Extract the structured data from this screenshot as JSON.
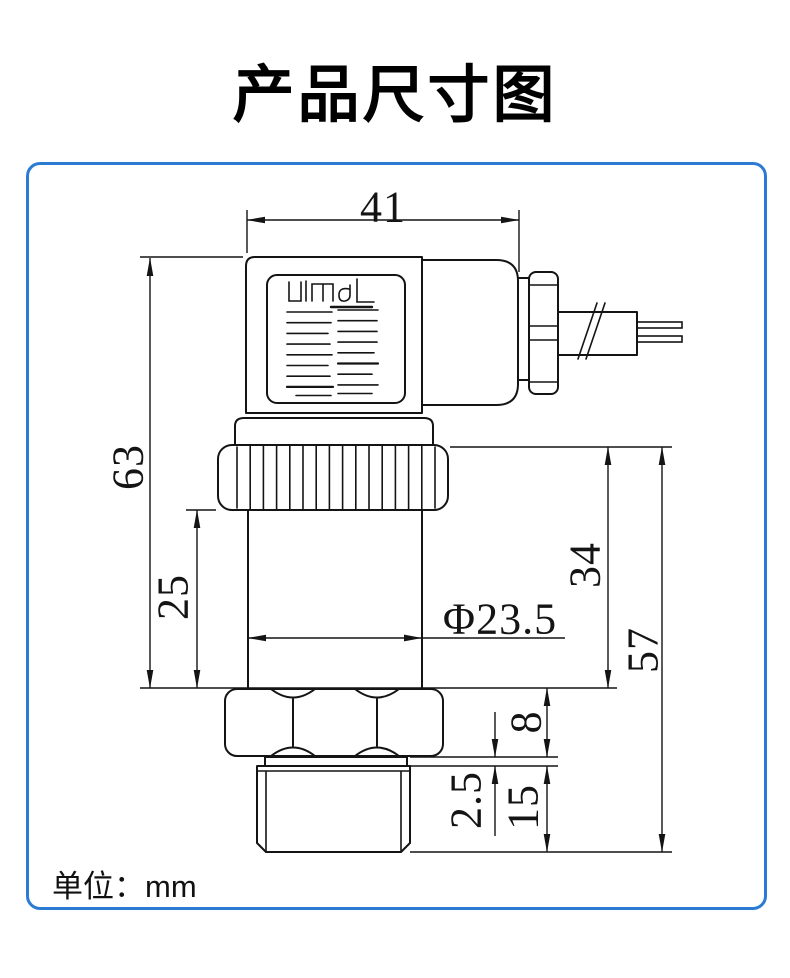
{
  "title": "产品尺寸图",
  "unit_label": "单位：mm",
  "colors": {
    "panel_border": "#2b7bd4",
    "line": "#141414"
  },
  "dimensions": {
    "connector_width": "41",
    "total_height": "63",
    "body_length": "25",
    "body_diameter": "Φ23.5",
    "lower_section_height": "34",
    "lower_total_height": "57",
    "hex_height": "8",
    "washer_thickness": "2.5",
    "thread_length": "15"
  }
}
